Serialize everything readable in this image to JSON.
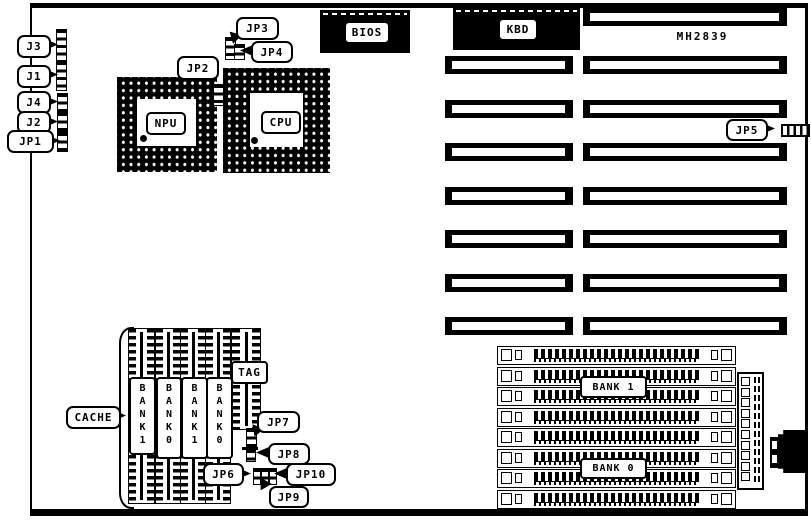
{
  "board": {
    "model": "MH2839",
    "slot_count_right": 8,
    "slot_count_left": 7,
    "simm_count": 8,
    "cache_column_count": 5
  },
  "chips": {
    "npu": "NPU",
    "cpu": "CPU",
    "bios": "BIOS",
    "kbd": "KBD",
    "tag": "TAG",
    "cache": "CACHE"
  },
  "jumpers": {
    "j3": "J3",
    "j1": "J1",
    "j4": "J4",
    "j2": "J2",
    "jp1": "JP1",
    "jp2": "JP2",
    "jp3": "JP3",
    "jp4": "JP4",
    "jp5": "JP5",
    "jp6": "JP6",
    "jp7": "JP7",
    "jp8": "JP8",
    "jp9": "JP9",
    "jp10": "JP10"
  },
  "cache_banks": [
    "BANK1",
    "BANK0",
    "BANK1",
    "BANK0"
  ],
  "memory": {
    "bank1": "BANK 1",
    "bank0": "BANK 0"
  },
  "colors": {
    "ink": "#000000",
    "paper": "#ffffff"
  }
}
